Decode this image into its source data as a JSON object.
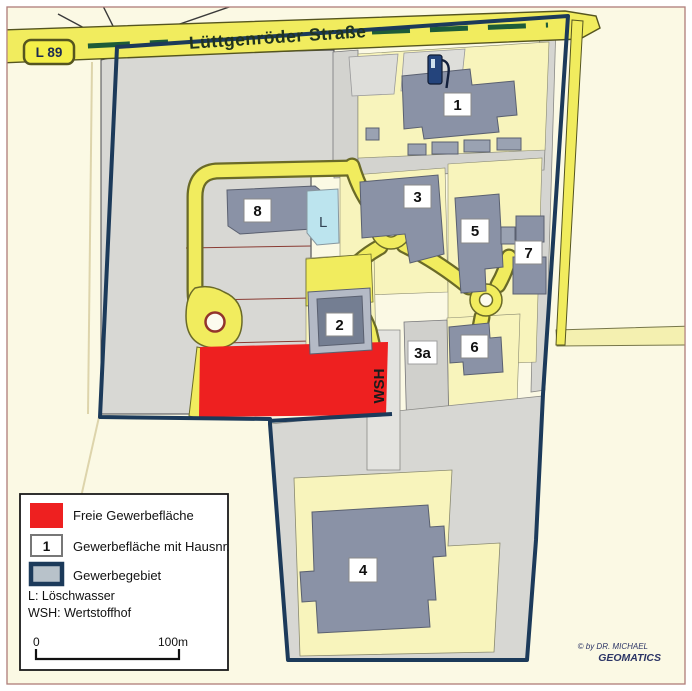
{
  "map": {
    "route_sign": "L 89",
    "street_name": "Lüttgenröder Straße",
    "building_labels": {
      "b1": "1",
      "b2": "2",
      "b3": "3",
      "b3a": "3a",
      "b4": "4",
      "b5": "5",
      "b6": "6",
      "b7": "7",
      "b8": "8"
    },
    "poi_labels": {
      "loeschwasser": "L",
      "wertstoffhof": "WSH"
    }
  },
  "legend": {
    "free_area_label": "Freie Gewerbefläche",
    "numbered_area_label": "Gewerbefläche mit Hausnr.",
    "numbered_swatch_text": "1",
    "district_label": "Gewerbegebiet",
    "note_l": "L: Löschwasser",
    "note_wsh": "WSH: Wertstoffhof",
    "scale_start": "0",
    "scale_end": "100m"
  },
  "credit": {
    "line1": "© by DR. MICHAEL",
    "line2": "GEOMATICS"
  },
  "colors": {
    "free_area_red": "#ee2020",
    "district_boundary_navy": "#1c3a5a",
    "road_yellow": "#f1ec5e",
    "parcel_yellow": "#f8f4bc",
    "building_gray": "#8a92a6",
    "water_blue": "#bce4ee"
  }
}
